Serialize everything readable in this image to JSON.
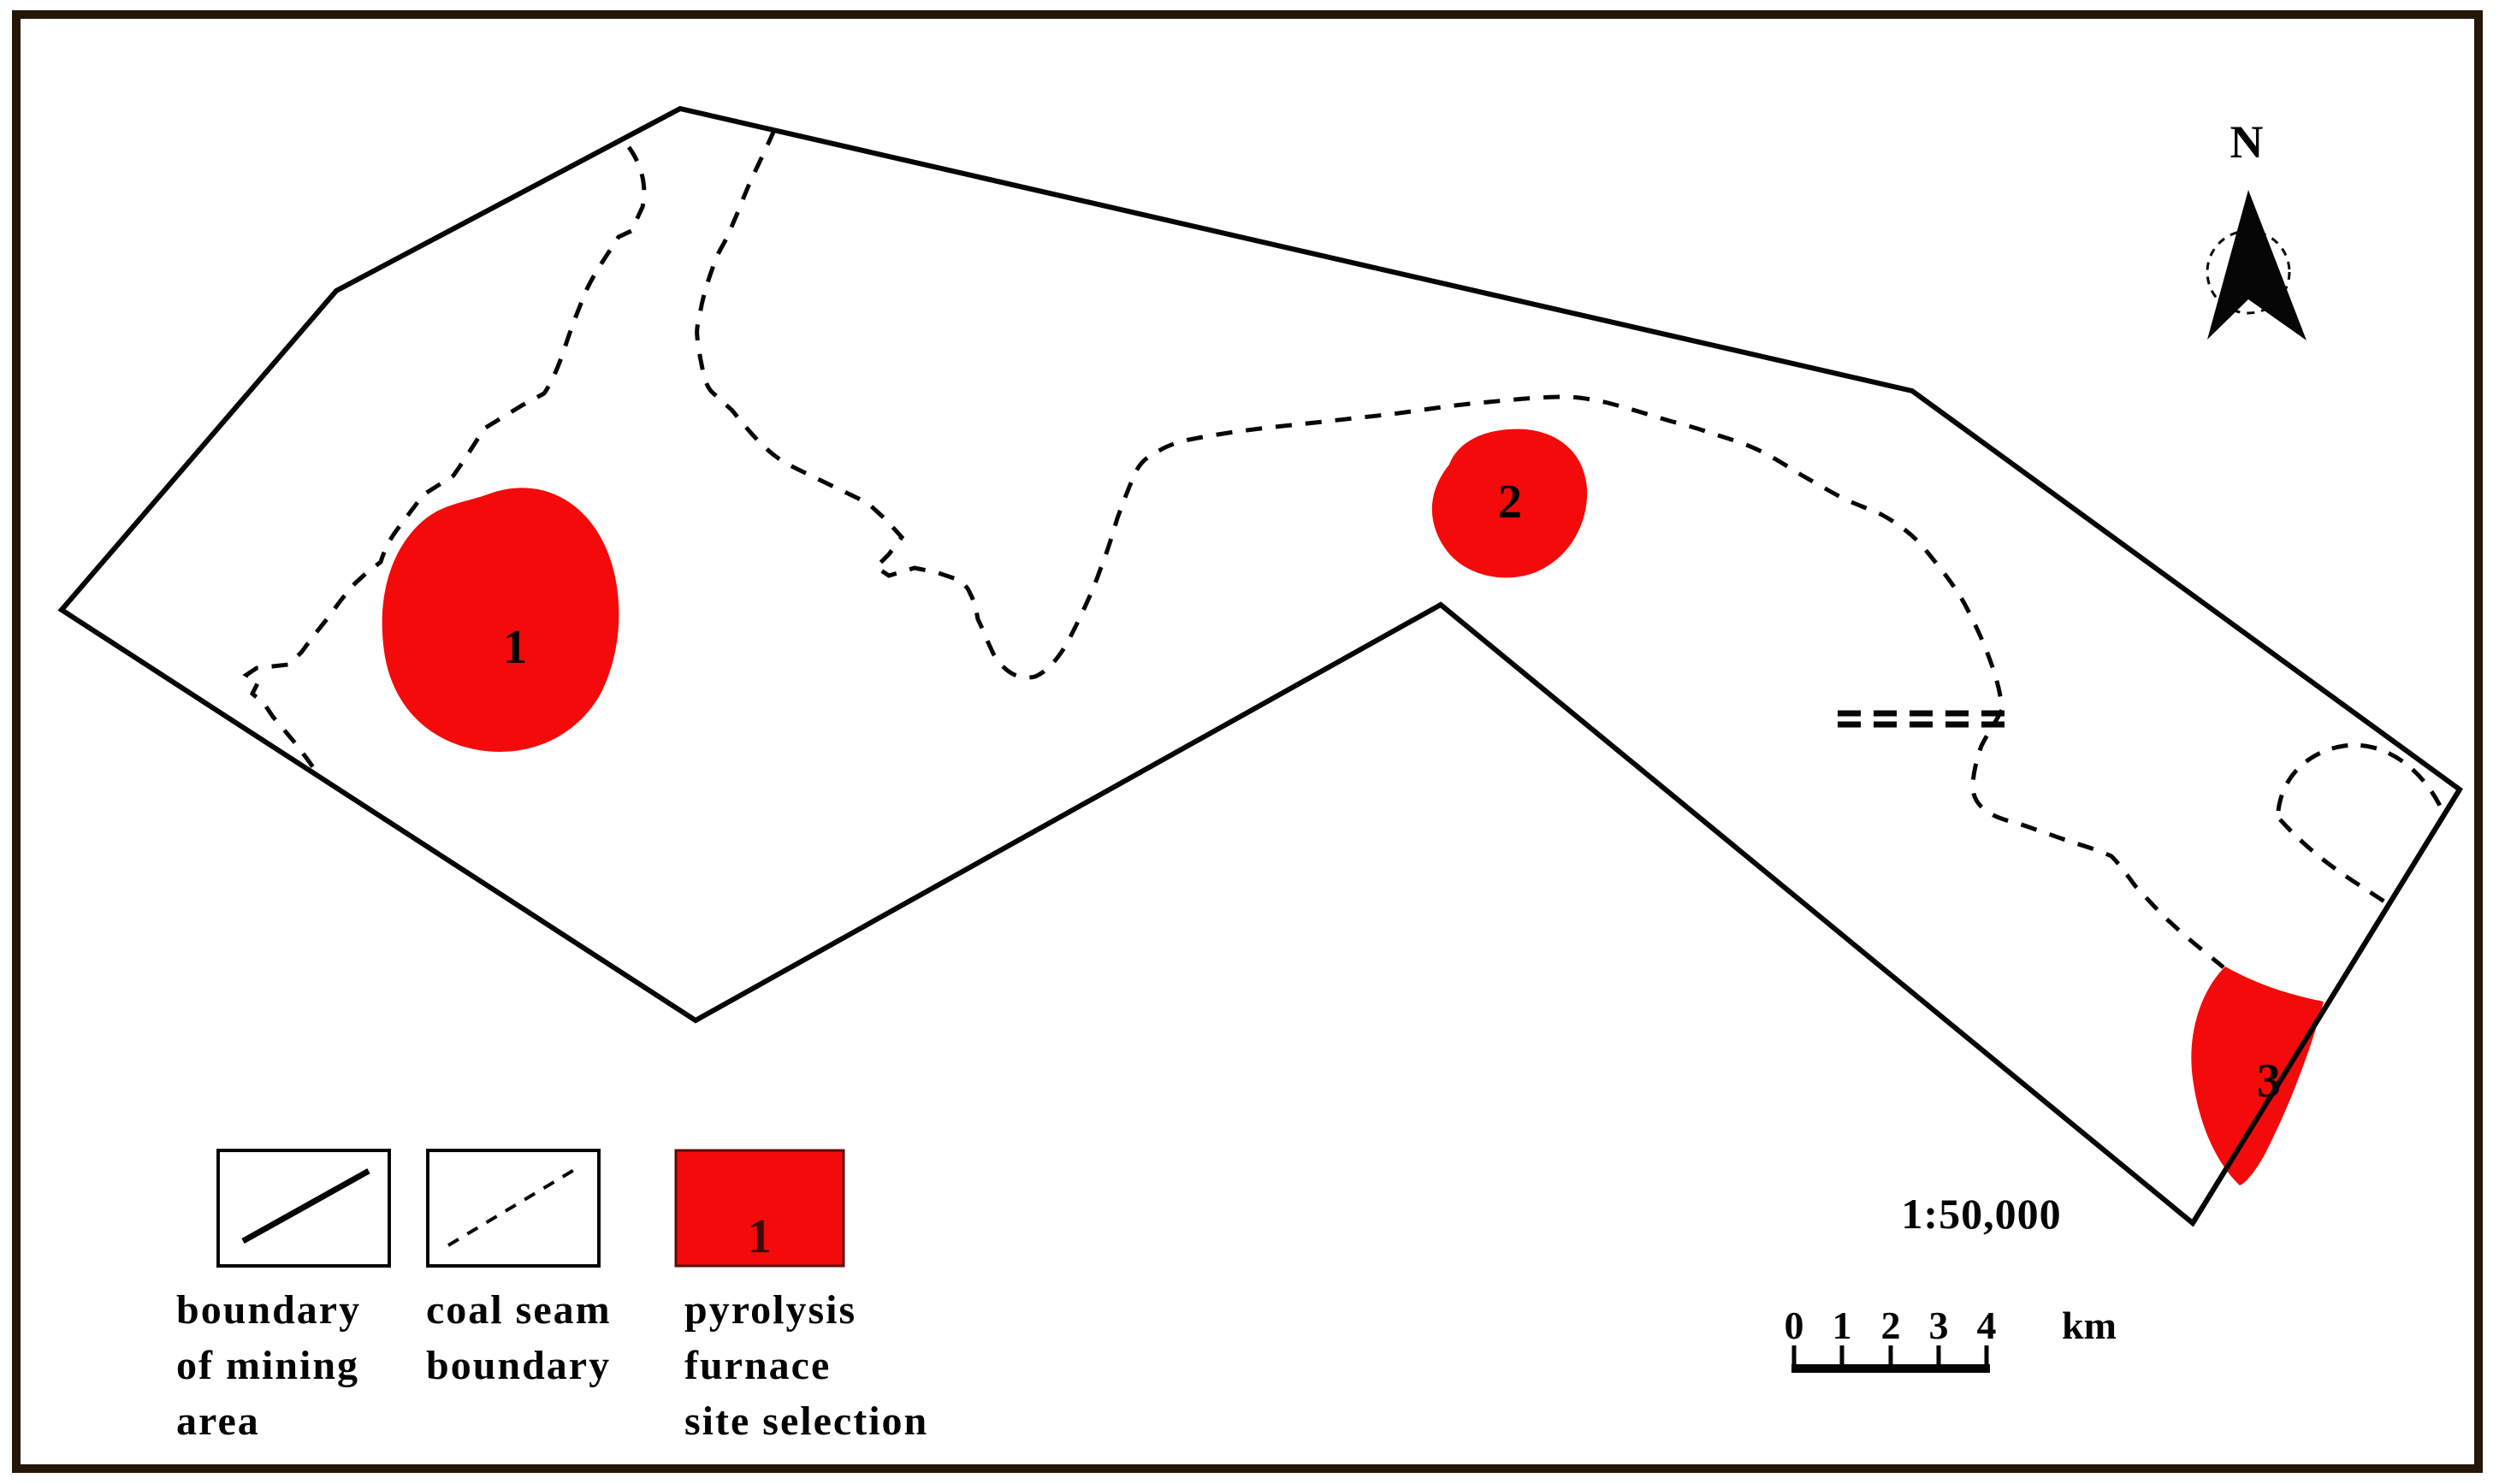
{
  "colors": {
    "site_red": "#f40a0a"
  },
  "north_indicator": {
    "label": "N"
  },
  "sites": {
    "site1": "1",
    "site2": "2",
    "site3": "3"
  },
  "scale": {
    "ratio": "1:50,000",
    "tick_labels": [
      "0",
      "1",
      "2",
      "3",
      "4"
    ],
    "unit": "km"
  },
  "legend": {
    "items": [
      {
        "lines": [
          "boundary",
          "of mining",
          "area"
        ]
      },
      {
        "lines": [
          "coal seam",
          "boundary"
        ]
      },
      {
        "swatch_label": "1",
        "lines": [
          "pyrolysis",
          "furnace",
          "site selection"
        ]
      }
    ]
  }
}
